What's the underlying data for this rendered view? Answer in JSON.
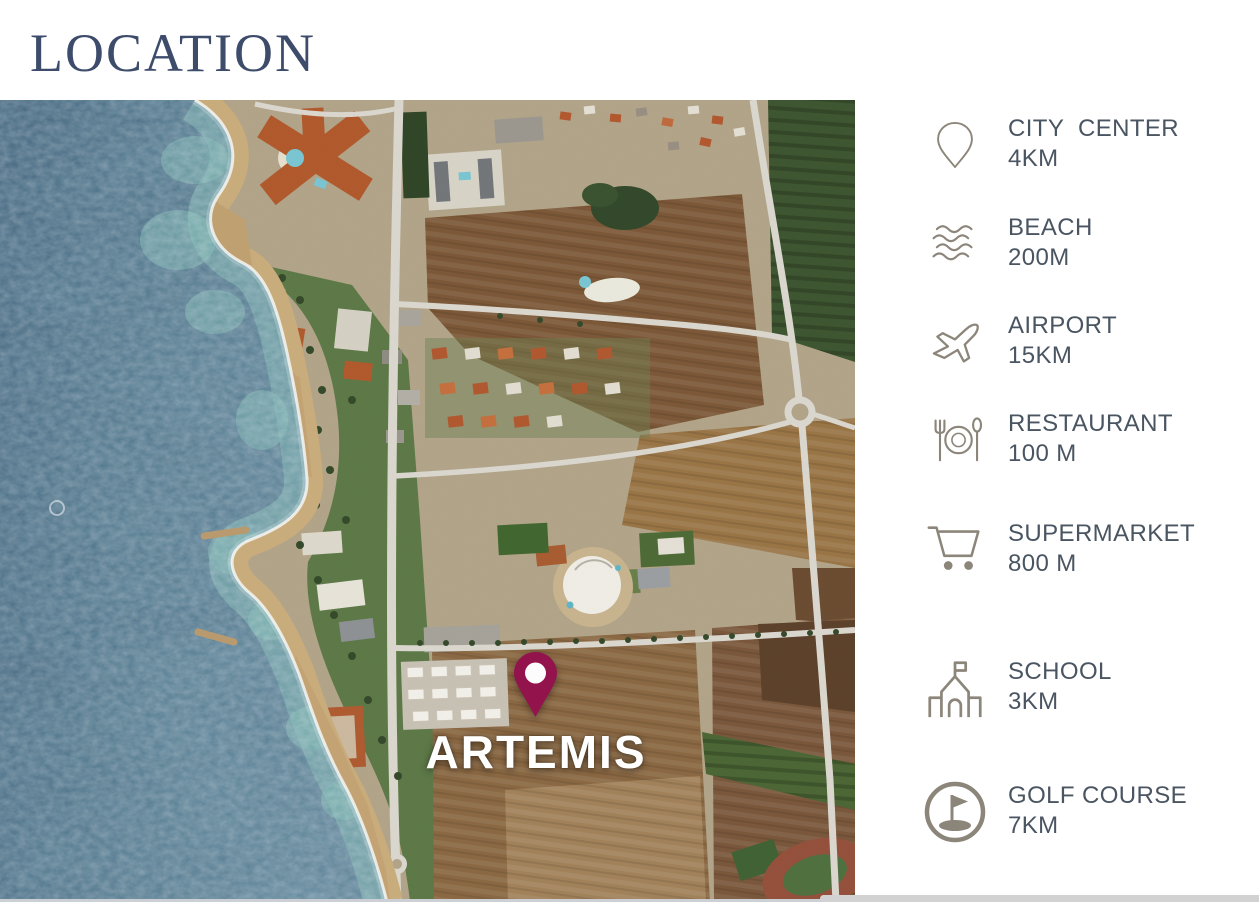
{
  "page": {
    "title": "LOCATION"
  },
  "theme": {
    "title_color": "#3e4c6b",
    "text_color": "#4a5562",
    "icon_color": "#8c857a",
    "pin_color": "#93134d",
    "label_color": "#ffffff",
    "panel_bg": "#ffffff",
    "strip_color": "#d2d2d2",
    "sea_color": "#4f7389",
    "sand_color": "#c9ac7b",
    "land_color": "#b3a58a",
    "road_color": "#dcd9d1"
  },
  "map": {
    "project_label": "ARTEMIS",
    "pin_icon": "map-pin",
    "description": "satellite aerial view of coastal town, sea on the left, fields on the right"
  },
  "amenities": {
    "items": [
      {
        "icon": "map-pin",
        "label": "CITY  CENTER",
        "distance": "4KM"
      },
      {
        "icon": "waves",
        "label": "BEACH",
        "distance": "200M"
      },
      {
        "icon": "airplane",
        "label": "AIRPORT",
        "distance": "15KM"
      },
      {
        "icon": "restaurant",
        "label": "RESTAURANT",
        "distance": "100 M"
      },
      {
        "icon": "shopping-cart",
        "label": "SUPERMARKET",
        "distance": "800 M"
      },
      {
        "icon": "school",
        "label": "SCHOOL",
        "distance": "3KM"
      },
      {
        "icon": "golf",
        "label": "GOLF COURSE",
        "distance": "7KM"
      }
    ]
  }
}
